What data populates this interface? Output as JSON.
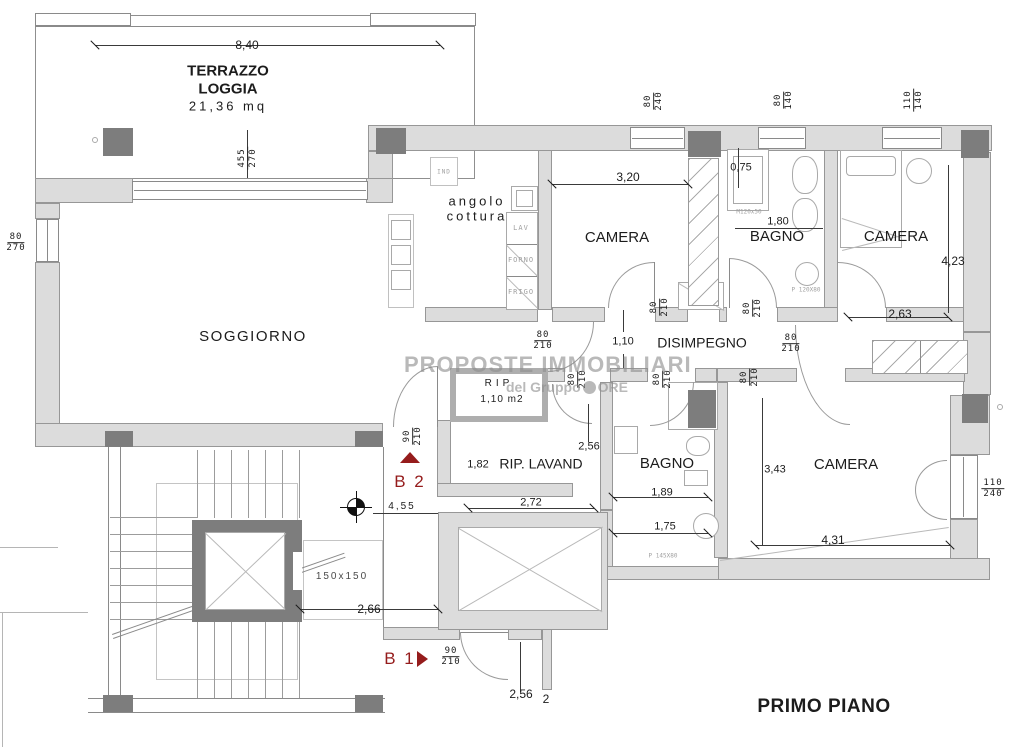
{
  "plan_title": "PRIMO PIANO",
  "watermark": {
    "line1": "PROPOSTE IMMOBILIARI",
    "line2_left": "del Gruppo",
    "line2_right": "ORE"
  },
  "colors": {
    "marker_red": "#951c1c",
    "wall_gray": "#dcdcdc",
    "pillar_gray": "#7d7d7d",
    "watermark_gray": "#8f8f8f"
  },
  "labels": [
    {
      "name": "dim-8-40",
      "text": "8,40",
      "x": 247,
      "y": 45,
      "fs": 12
    },
    {
      "name": "room-terrazzo",
      "text": "TERRAZZO\nLOGGIA",
      "x": 228,
      "y": 80,
      "fs": 15,
      "bold": true
    },
    {
      "name": "terrazzo-area",
      "text": "21,36 mq",
      "x": 228,
      "y": 106,
      "fs": 13,
      "ls": 3
    },
    {
      "name": "room-soggiorno",
      "text": "SOGGIORNO",
      "x": 253,
      "y": 337,
      "fs": 15,
      "ls": 1.5
    },
    {
      "name": "room-angolo-cottura",
      "text": "angolo\ncottura",
      "x": 477,
      "y": 209,
      "fs": 13,
      "ls": 3
    },
    {
      "name": "appliance-ind",
      "text": "IND",
      "x": 444,
      "y": 172,
      "fs": 6,
      "ls": 1,
      "color": "#a0a0a0",
      "mono": true
    },
    {
      "name": "appliance-lav",
      "text": "LAV",
      "x": 521,
      "y": 228,
      "fs": 7,
      "ls": 1,
      "color": "#a0a0a0",
      "mono": true
    },
    {
      "name": "appliance-forno",
      "text": "FORNO",
      "x": 521,
      "y": 260,
      "fs": 7,
      "ls": 1,
      "color": "#a0a0a0",
      "mono": true
    },
    {
      "name": "appliance-frigo",
      "text": "FRIGO",
      "x": 521,
      "y": 292,
      "fs": 7,
      "ls": 1,
      "color": "#a0a0a0",
      "mono": true
    },
    {
      "name": "room-camera-1",
      "text": "CAMERA",
      "x": 617,
      "y": 238,
      "fs": 15
    },
    {
      "name": "dim-3-20",
      "text": "3,20",
      "x": 628,
      "y": 177,
      "fs": 12
    },
    {
      "name": "room-bagno-1",
      "text": "BAGNO",
      "x": 777,
      "y": 237,
      "fs": 15
    },
    {
      "name": "dim-0-75",
      "text": "0,75",
      "x": 741,
      "y": 168,
      "fs": 11
    },
    {
      "name": "dim-1-80",
      "text": "1,80",
      "x": 778,
      "y": 222,
      "fs": 11
    },
    {
      "name": "fixture-m120x50",
      "text": "M120x50",
      "x": 749,
      "y": 212,
      "fs": 6,
      "color": "#a0a0a0",
      "mono": true
    },
    {
      "name": "fixture-p120x80",
      "text": "P 120X80",
      "x": 806,
      "y": 290,
      "fs": 6,
      "color": "#a0a0a0",
      "mono": true
    },
    {
      "name": "room-camera-2",
      "text": "CAMERA",
      "x": 896,
      "y": 237,
      "fs": 15
    },
    {
      "name": "dim-4-23",
      "text": "4,23",
      "x": 953,
      "y": 261,
      "fs": 12
    },
    {
      "name": "dim-2-63",
      "text": "2,63",
      "x": 900,
      "y": 314,
      "fs": 12
    },
    {
      "name": "room-disimpegno",
      "text": "DISIMPEGNO",
      "x": 702,
      "y": 343,
      "fs": 14
    },
    {
      "name": "dim-1-10",
      "text": "1,10",
      "x": 623,
      "y": 342,
      "fs": 11
    },
    {
      "name": "room-rip",
      "text": "RIP",
      "x": 499,
      "y": 384,
      "fs": 10,
      "ls": 4
    },
    {
      "name": "rip-area",
      "text": "1,10 m2",
      "x": 502,
      "y": 400,
      "fs": 10,
      "ls": 1
    },
    {
      "name": "dim-2-56-a",
      "text": "2,56",
      "x": 589,
      "y": 447,
      "fs": 11
    },
    {
      "name": "dim-1-82",
      "text": "1,82",
      "x": 478,
      "y": 465,
      "fs": 11
    },
    {
      "name": "room-rip-lavand",
      "text": "RIP. LAVAND",
      "x": 541,
      "y": 464,
      "fs": 14
    },
    {
      "name": "dim-2-72",
      "text": "2,72",
      "x": 531,
      "y": 503,
      "fs": 11
    },
    {
      "name": "room-bagno-2",
      "text": "BAGNO",
      "x": 667,
      "y": 464,
      "fs": 15
    },
    {
      "name": "dim-1-89",
      "text": "1,89",
      "x": 662,
      "y": 493,
      "fs": 11
    },
    {
      "name": "dim-1-75",
      "text": "1,75",
      "x": 665,
      "y": 527,
      "fs": 11
    },
    {
      "name": "fixture-p145x80",
      "text": "P 145X80",
      "x": 663,
      "y": 556,
      "fs": 6,
      "color": "#a0a0a0",
      "mono": true
    },
    {
      "name": "room-camera-3",
      "text": "CAMERA",
      "x": 846,
      "y": 465,
      "fs": 15
    },
    {
      "name": "dim-3-43",
      "text": "3,43",
      "x": 775,
      "y": 470,
      "fs": 11
    },
    {
      "name": "dim-4-31",
      "text": "4,31",
      "x": 833,
      "y": 540,
      "fs": 12
    },
    {
      "name": "dim-4-55",
      "text": "4,55",
      "x": 402,
      "y": 507,
      "fs": 10,
      "ls": 2
    },
    {
      "name": "marker-b2",
      "text": "B 2",
      "x": 410,
      "y": 482,
      "fs": 17,
      "ls": 2,
      "color": "#951c1c"
    },
    {
      "name": "marker-b1",
      "text": "B 1",
      "x": 400,
      "y": 659,
      "fs": 17,
      "ls": 2,
      "color": "#951c1c"
    },
    {
      "name": "elevator-size",
      "text": "150x150",
      "x": 342,
      "y": 577,
      "fs": 10,
      "ls": 2,
      "color": "#4a4a4a"
    },
    {
      "name": "dim-2-66",
      "text": "2,66",
      "x": 369,
      "y": 609,
      "fs": 12
    },
    {
      "name": "dim-2-56-b",
      "text": "2,56",
      "x": 521,
      "y": 694,
      "fs": 12
    },
    {
      "name": "dim-2-cut",
      "text": "2",
      "x": 546,
      "y": 699,
      "fs": 12
    },
    {
      "name": "plan-title",
      "text": "PRIMO PIANO",
      "x": 824,
      "y": 707,
      "fs": 19,
      "bold": true,
      "ls": 0.5
    }
  ],
  "fractions": [
    {
      "name": "dim-455-270",
      "top": "455",
      "bottom": "270",
      "x": 248,
      "y": 158,
      "rot": -90
    },
    {
      "name": "dim-80-270",
      "top": "80",
      "bottom": "270",
      "x": 16,
      "y": 243,
      "rot": 0
    },
    {
      "name": "dim-80-240",
      "top": "80",
      "bottom": "240",
      "x": 654,
      "y": 101,
      "rot": -90
    },
    {
      "name": "dim-80-140",
      "top": "80",
      "bottom": "140",
      "x": 784,
      "y": 100,
      "rot": -90
    },
    {
      "name": "dim-110-140",
      "top": "110",
      "bottom": "140",
      "x": 914,
      "y": 100,
      "rot": -90
    },
    {
      "name": "dim-80-210-a",
      "top": "80",
      "bottom": "210",
      "x": 543,
      "y": 341,
      "rot": 0
    },
    {
      "name": "dim-80-210-b",
      "top": "80",
      "bottom": "210",
      "x": 660,
      "y": 307,
      "rot": -90
    },
    {
      "name": "dim-80-210-c",
      "top": "80",
      "bottom": "210",
      "x": 753,
      "y": 308,
      "rot": -90
    },
    {
      "name": "dim-80-210-d",
      "top": "80",
      "bottom": "210",
      "x": 791,
      "y": 344,
      "rot": 0
    },
    {
      "name": "dim-80-210-e",
      "top": "80",
      "bottom": "210",
      "x": 578,
      "y": 379,
      "rot": -90
    },
    {
      "name": "dim-80-210-f",
      "top": "80",
      "bottom": "210",
      "x": 663,
      "y": 379,
      "rot": -90
    },
    {
      "name": "dim-80-210-g",
      "top": "80",
      "bottom": "210",
      "x": 750,
      "y": 377,
      "rot": -90
    },
    {
      "name": "dim-90-210-b2",
      "top": "90",
      "bottom": "210",
      "x": 413,
      "y": 436,
      "rot": -90
    },
    {
      "name": "dim-90-210-b1",
      "top": "90",
      "bottom": "210",
      "x": 451,
      "y": 657,
      "rot": 0
    },
    {
      "name": "dim-110-240",
      "top": "110",
      "bottom": "240",
      "x": 993,
      "y": 489,
      "rot": 0
    }
  ]
}
